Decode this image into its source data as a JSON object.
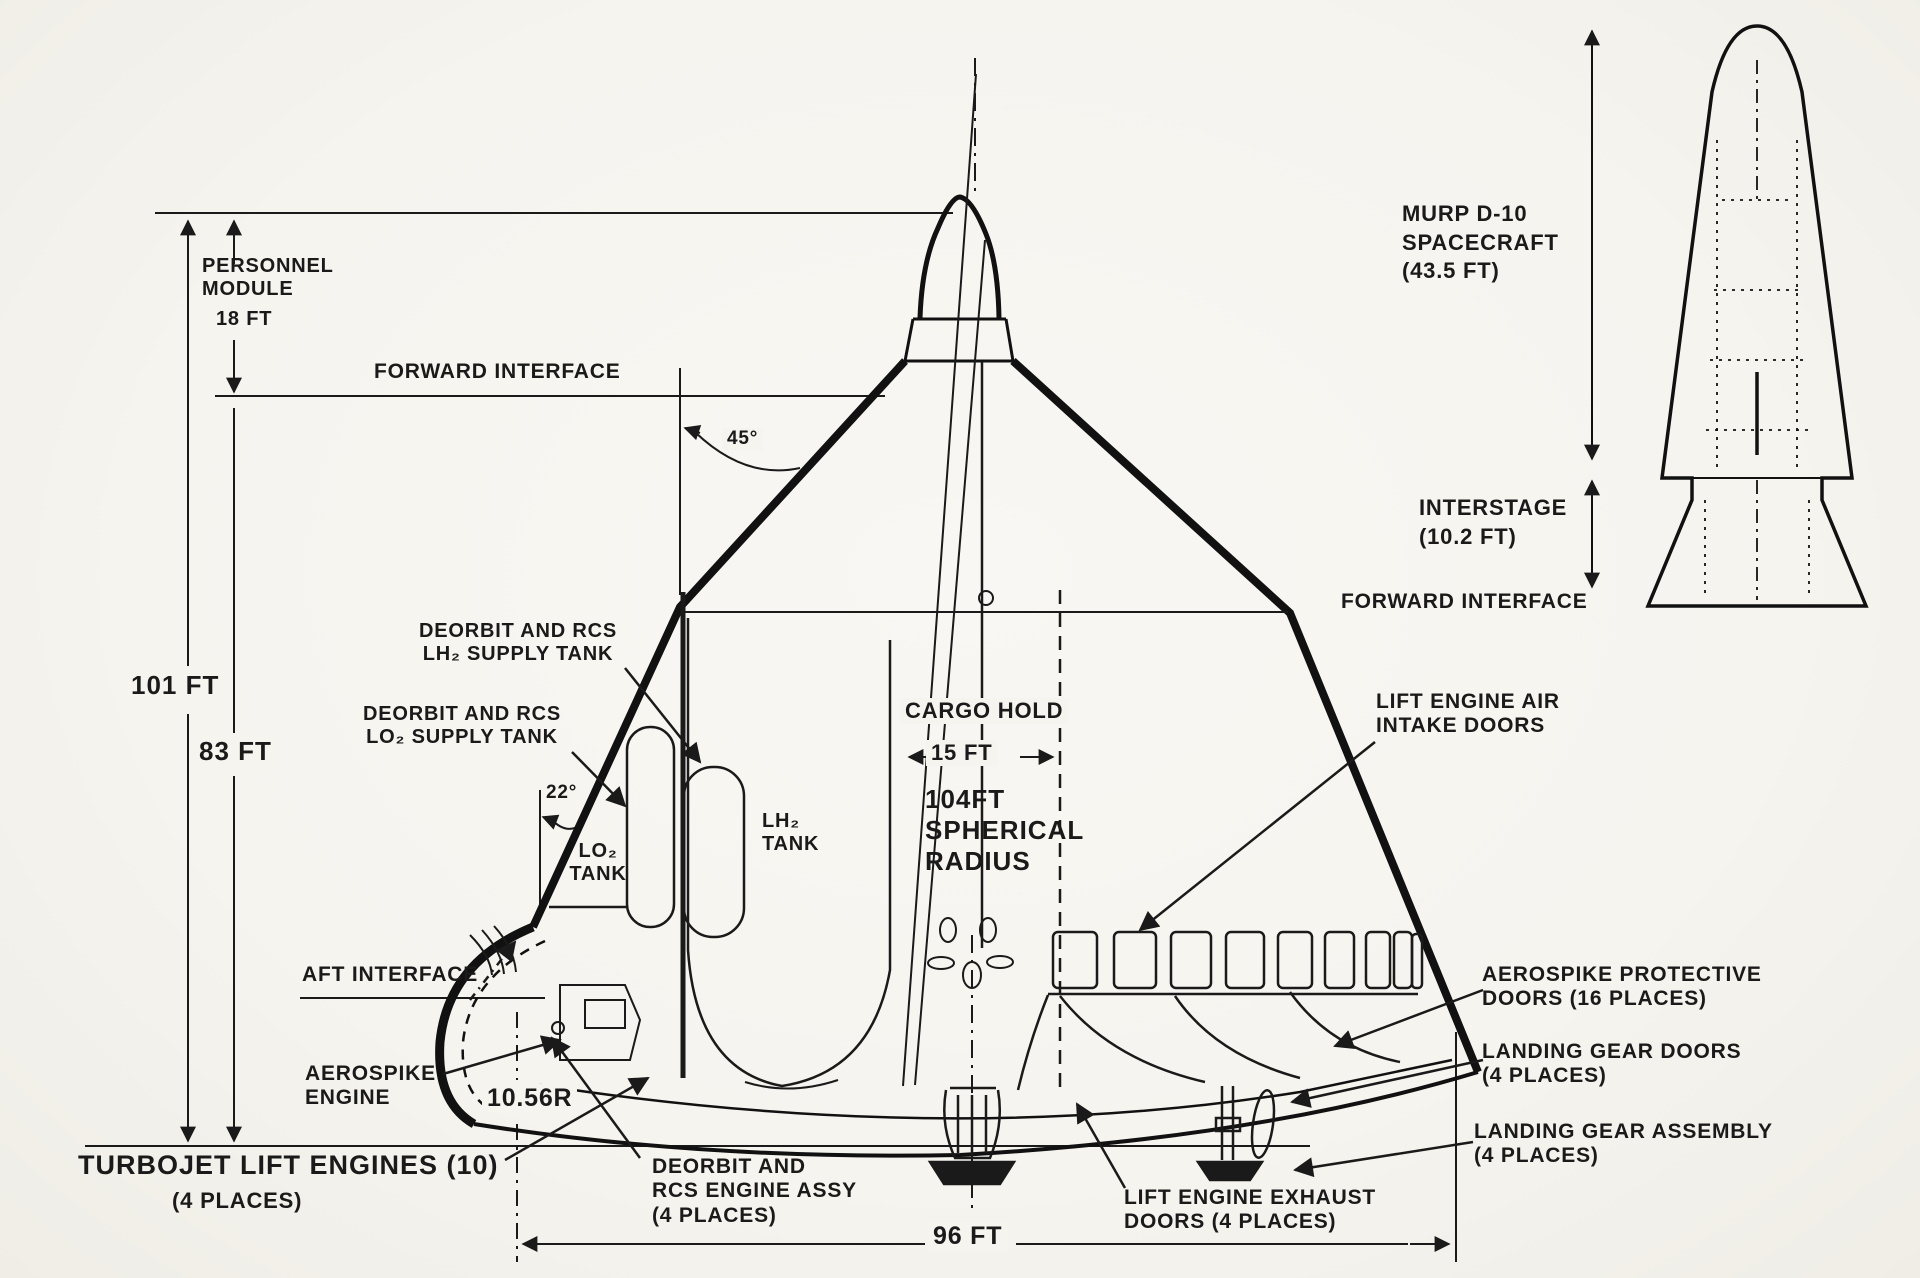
{
  "colors": {
    "paper": "#f6f4ef",
    "ink": "#1a1a1a"
  },
  "labels": {
    "personnel_module": "PERSONNEL\nMODULE",
    "personnel_module_dim": "18 FT",
    "forward_interface": "FORWARD INTERFACE",
    "angle_45": "45°",
    "height_101": "101 FT",
    "height_83": "83 FT",
    "deorbit_lh2": "DEORBIT AND RCS\nLH₂ SUPPLY TANK",
    "deorbit_lo2": "DEORBIT AND RCS\nLO₂ SUPPLY TANK",
    "angle_22": "22°",
    "lo2_tank": "LO₂\nTANK",
    "lh2_tank": "LH₂\nTANK",
    "cargo_hold": "CARGO HOLD",
    "cargo_width": "15 FT",
    "spherical_radius": "104FT\nSPHERICAL\nRADIUS",
    "aft_interface": "AFT INTERFACE",
    "aerospike_engine": "AEROSPIKE\nENGINE",
    "radius_1056": "10.56R",
    "turbojet": "TURBOJET LIFT ENGINES (10)",
    "turbojet_places": "(4 PLACES)",
    "deorbit_assy": "DEORBIT AND\nRCS ENGINE ASSY\n(4 PLACES)",
    "length_96": "96 FT",
    "exhaust_doors": "LIFT ENGINE EXHAUST\nDOORS (4 PLACES)",
    "intake_doors": "LIFT ENGINE AIR\nINTAKE DOORS",
    "protective_doors": "AEROSPIKE PROTECTIVE\nDOORS (16 PLACES)",
    "gear_doors": "LANDING GEAR DOORS\n(4 PLACES)",
    "gear_assembly": "LANDING GEAR ASSEMBLY\n(4 PLACES)",
    "murp": "MURP D-10\nSPACECRAFT\n(43.5 FT)",
    "interstage": "INTERSTAGE\n(10.2 FT)",
    "forward_interface_right": "FORWARD INTERFACE"
  }
}
